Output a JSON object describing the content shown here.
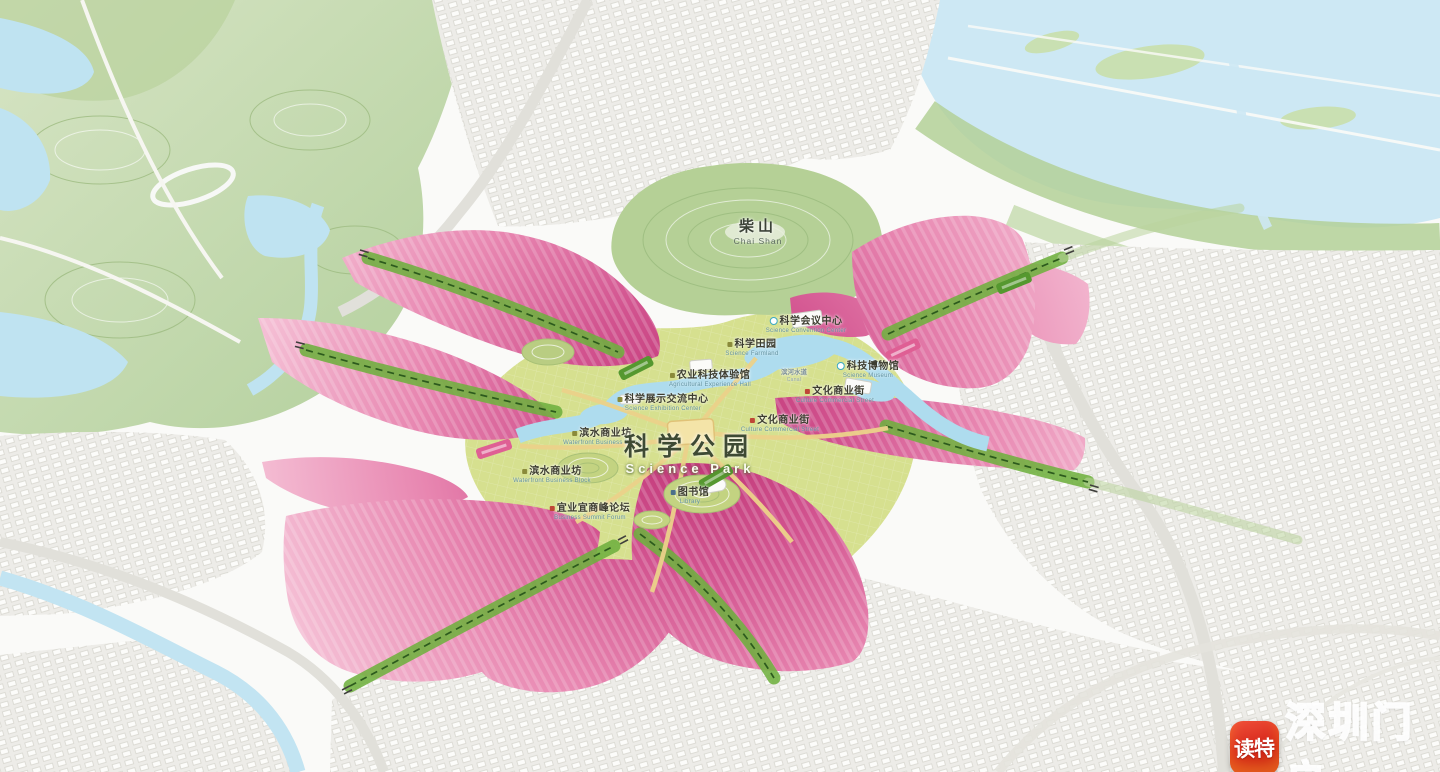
{
  "map": {
    "mountain": {
      "zh": "柴山",
      "en": "Chai Shan"
    },
    "park": {
      "zh": "科学公园",
      "en": "Science Park"
    },
    "pois": {
      "conference_center": {
        "zh": "科学会议中心",
        "en": "Science Convention Center"
      },
      "science_field": {
        "zh": "科学田园",
        "en": "Science Farmland"
      },
      "agri_hall": {
        "zh": "农业科技体验馆",
        "en": "Agricultural Experience Hall"
      },
      "exhibition_center": {
        "zh": "科学展示交流中心",
        "en": "Science Exhibition Center"
      },
      "museum": {
        "zh": "科技博物馆",
        "en": "Science Museum"
      },
      "culture_street": {
        "zh": "文化商业街",
        "en": "Culture Commercial Street"
      },
      "waterfront_block": {
        "zh": "滨水商业坊",
        "en": "Waterfront Business Block"
      },
      "library": {
        "zh": "图书馆",
        "en": "Library"
      },
      "summit_forum": {
        "zh": "宜业宜商峰论坛",
        "en": "Business Summit Forum"
      },
      "canal": {
        "zh": "滨河水道",
        "en": "Canal"
      }
    }
  },
  "watermark": {
    "app_name": "读特",
    "site_name": "深圳门户"
  },
  "colors": {
    "pink_core": "#bd3273",
    "pink_edge": "#f6c6d9",
    "corridor_green": "#6fb03f",
    "park_green": "#d6e08f",
    "hill_green": "#b7d29a",
    "water_blue": "#bfe3f1",
    "watermark_red": "#d32317"
  }
}
